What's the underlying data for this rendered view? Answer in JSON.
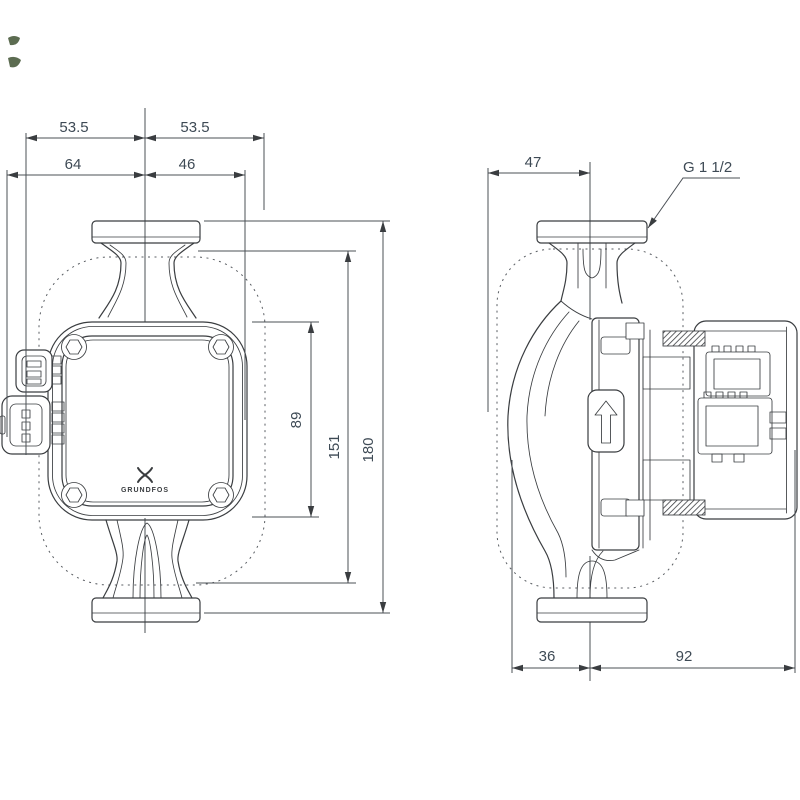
{
  "drawing": {
    "front_view": {
      "dim_top_left_half": "53.5",
      "dim_top_right_half": "53.5",
      "dim_left_width": "64",
      "dim_right_width": "46",
      "dim_head_height": "89",
      "dim_inner_height": "151",
      "dim_total_height": "180",
      "logo_text": "GRUNDFOS"
    },
    "side_view": {
      "dim_top_width": "47",
      "thread_label": "G 1 1/2",
      "dim_bottom_left": "36",
      "dim_bottom_right": "92"
    },
    "colors": {
      "outline": "#3a3d40",
      "dimension_text": "#3e4a55",
      "dashed_envelope": "#5a5e63",
      "artifact": "#3f5233"
    }
  }
}
